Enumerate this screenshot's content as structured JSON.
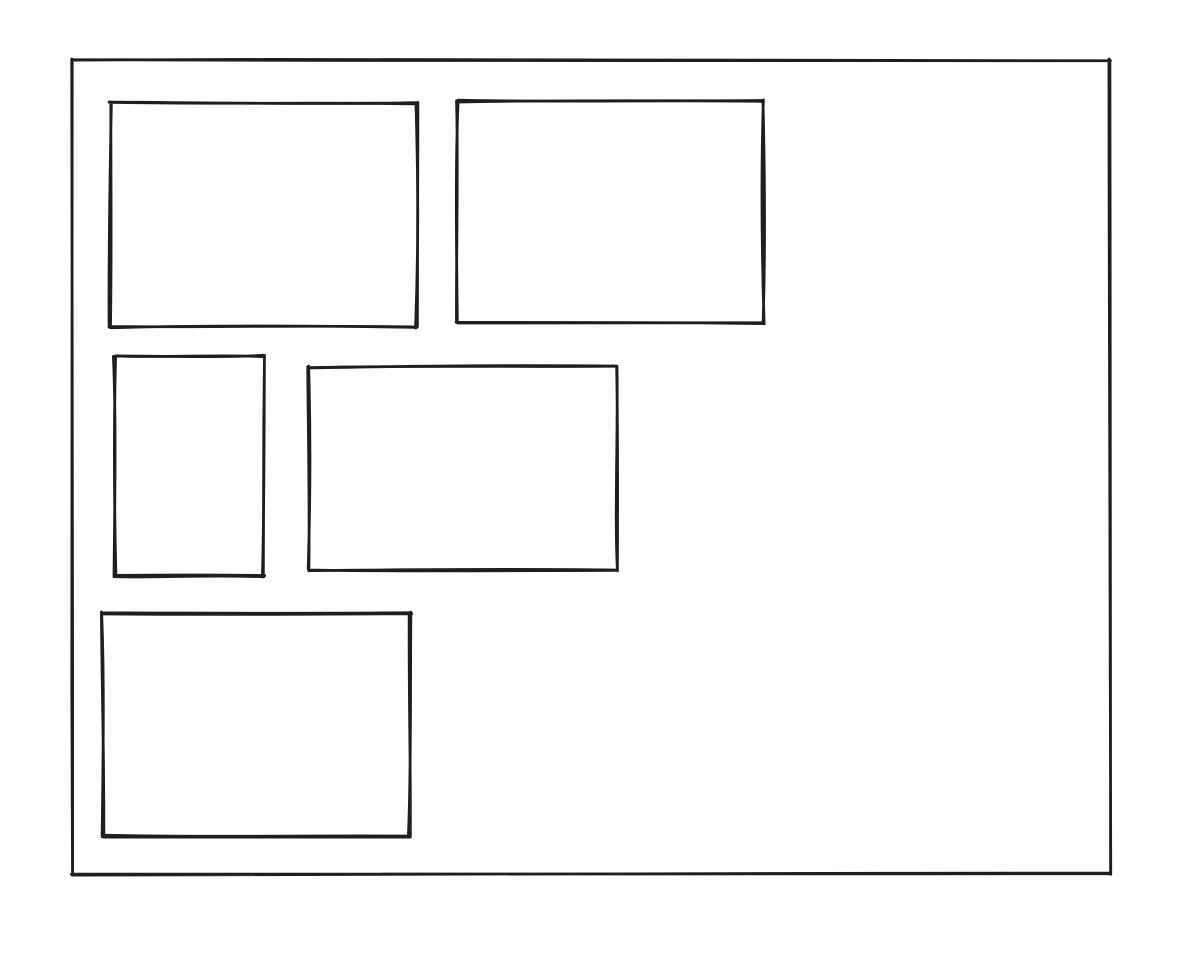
{
  "canvas": {
    "width": 1192,
    "height": 956,
    "background_color": "#ffffff"
  },
  "style": {
    "stroke_color": "#1e1e1e",
    "stroke_width": 2.8,
    "fill": "transparent",
    "sketch_roughness": 2.2
  },
  "shapes": [
    {
      "name": "outer-frame-rectangle",
      "type": "rectangle",
      "x": 72,
      "y": 60,
      "width": 1038,
      "height": 814,
      "seed": 11
    },
    {
      "name": "top-left-rectangle",
      "type": "rectangle",
      "x": 110,
      "y": 103,
      "width": 307,
      "height": 224,
      "seed": 23
    },
    {
      "name": "top-right-rectangle",
      "type": "rectangle",
      "x": 457,
      "y": 101,
      "width": 306,
      "height": 222,
      "seed": 37
    },
    {
      "name": "middle-left-rectangle",
      "type": "rectangle",
      "x": 115,
      "y": 356,
      "width": 149,
      "height": 220,
      "seed": 41
    },
    {
      "name": "middle-center-rectangle",
      "type": "rectangle",
      "x": 309,
      "y": 367,
      "width": 307,
      "height": 203,
      "seed": 53
    },
    {
      "name": "bottom-left-rectangle",
      "type": "rectangle",
      "x": 103,
      "y": 613,
      "width": 307,
      "height": 223,
      "seed": 67
    }
  ]
}
